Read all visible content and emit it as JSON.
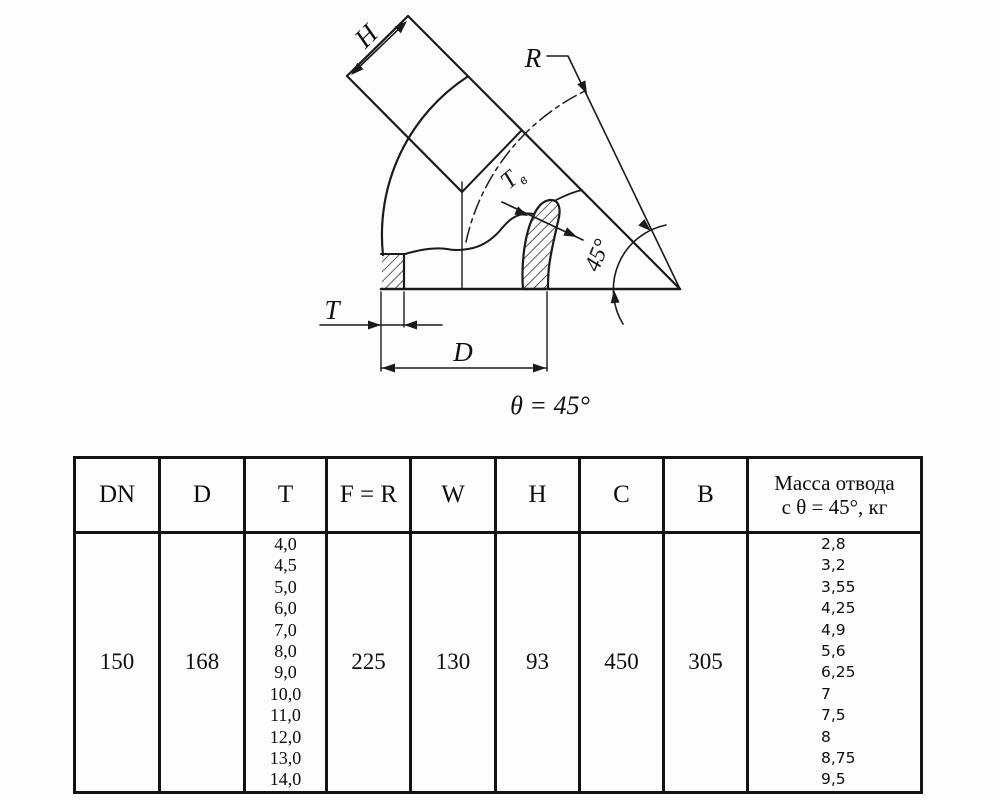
{
  "diagram": {
    "caption": "θ = 45°",
    "labels": {
      "h": "H",
      "r": "R",
      "tv_main": "Т",
      "tv_sub": "в",
      "angle": "45°",
      "t": "T",
      "d": "D"
    }
  },
  "table": {
    "headers": [
      "DN",
      "D",
      "T",
      "F = R",
      "W",
      "H",
      "C",
      "B"
    ],
    "mass_header": [
      "Масса отвода",
      "с θ = 45°, кг"
    ],
    "row": {
      "dn": "150",
      "d": "168",
      "t_values": [
        "4,0",
        "4,5",
        "5,0",
        "6,0",
        "7,0",
        "8,0",
        "9,0",
        "10,0",
        "11,0",
        "12,0",
        "13,0",
        "14,0"
      ],
      "f_r": "225",
      "w": "130",
      "h": "93",
      "c": "450",
      "b": "305",
      "mass_values": [
        "2,8",
        "3,2",
        "3,55",
        "4,25",
        "4,9",
        "5,6",
        "6,25",
        "7",
        "7,5",
        "8",
        "8,75",
        "9,5"
      ]
    }
  },
  "colors": {
    "line": "#1a1a1a",
    "background": "#fdfdfc"
  }
}
